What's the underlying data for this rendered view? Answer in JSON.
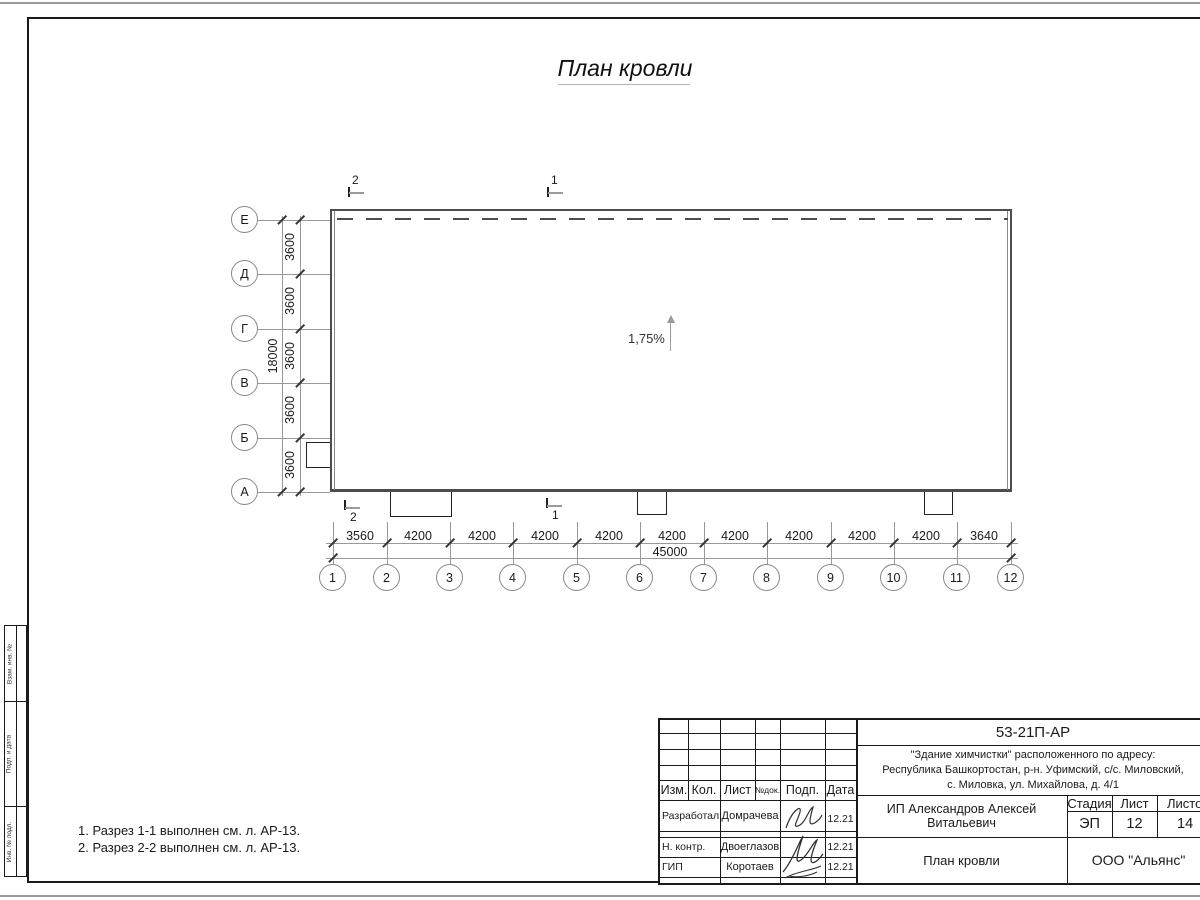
{
  "sheet": {
    "title": "План кровли",
    "notes": [
      "1. Разрез 1-1 выполнен см. л. АР-13.",
      "2. Разрез 2-2 выполнен см. л. АР-13."
    ]
  },
  "plan": {
    "slope": "1,75%",
    "rows": [
      "Е",
      "Д",
      "Г",
      "В",
      "Б",
      "А"
    ],
    "cols": [
      "1",
      "2",
      "3",
      "4",
      "5",
      "6",
      "7",
      "8",
      "9",
      "10",
      "11",
      "12"
    ],
    "row_dims": [
      "3600",
      "3600",
      "3600",
      "3600",
      "3600"
    ],
    "row_total": "18000",
    "col_dims": [
      "3560",
      "4200",
      "4200",
      "4200",
      "4200",
      "4200",
      "4200",
      "4200",
      "4200",
      "4200",
      "3640"
    ],
    "col_total": "45000",
    "sections": {
      "top_2": "2",
      "top_1": "1",
      "bot_2": "2",
      "bot_1": "1"
    }
  },
  "side_stamps": {
    "box1": "Взам. инв. №",
    "box2": "Подп. и дата",
    "box3": "Инв. № подл."
  },
  "title_block": {
    "doc_number": "53-21П-АР",
    "address": [
      "\"Здание химчистки\" расположенного по адресу:",
      "Республика Башкортостан, р-н. Уфимский, с/с. Миловский,",
      "с. Миловка, ул. Михайлова, д. 4/1"
    ],
    "header": {
      "izm": "Изм.",
      "kol": "Кол.",
      "list": "Лист",
      "ndok": "№док.",
      "podp": "Подп.",
      "data": "Дата"
    },
    "signers": [
      {
        "role": "Разработал",
        "name": "Домрачева",
        "date": "12.21"
      },
      {
        "role": "Н. контр.",
        "name": "Двоеглазов",
        "date": "12.21"
      },
      {
        "role": "ГИП",
        "name": "Коротаев",
        "date": "12.21"
      }
    ],
    "client": "ИП Александров Алексей Витальевич",
    "stage_label": "Стадия",
    "sheet_label": "Лист",
    "sheets_label": "Листов",
    "stage": "ЭП",
    "sheet_num": "12",
    "sheets_total": "14",
    "drawing_title": "План кровли",
    "company": "ООО \"Альянс\""
  },
  "colors": {
    "line": "#1a1a1a",
    "wall": "#4d4d4d",
    "light_line": "#999999",
    "paper": "#ffffff"
  }
}
